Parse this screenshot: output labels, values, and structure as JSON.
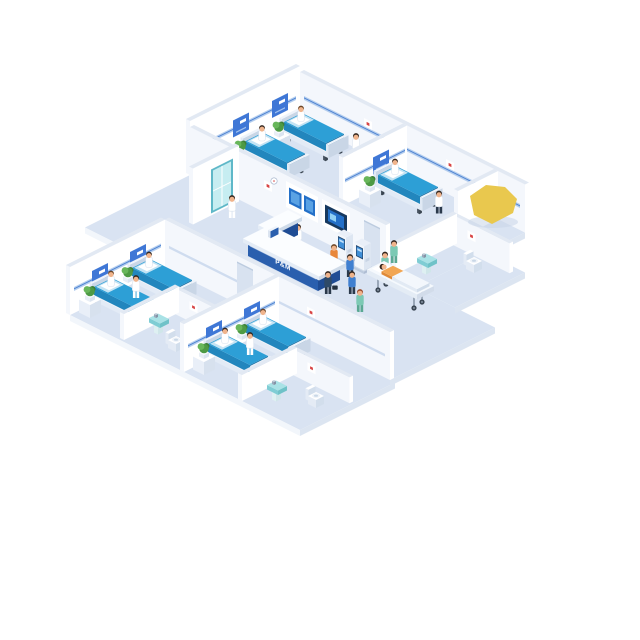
{
  "image": {
    "description": "Isometric cutaway illustration of a hospital ward floor with patient rooms, reception and corridor",
    "background": "#ffffff"
  },
  "reception": {
    "desk_label": "P&M"
  },
  "palette": {
    "floor": "#d9e3f2",
    "floor_edge_front": "#f2f6fb",
    "floor_edge_side": "#dce5f1",
    "wall_top": "#e2e9f3",
    "wall_face_left": "#f4f7fc",
    "wall_face_right": "#ffffff",
    "rail_light": "#b3cdee",
    "rail_dark": "#4a7fd0",
    "headboard_panel": "#3f77d6",
    "bed_mattress_top": "#2d9fd6",
    "bed_mattress_left": "#2286bd",
    "bed_mattress_right": "#1a6fa2",
    "bed_sheet": "#c3e3f4",
    "bed_frame_top": "#f2f6fb",
    "bed_frame_left": "#e3ebf6",
    "bed_frame_right": "#cdd9e8",
    "pillow": "#ffffff",
    "table_top": "#ffffff",
    "table_left": "#e9eff8",
    "table_right": "#d7e1ee",
    "pot": "#f6f9fc",
    "plant_dark": "#3d8038",
    "plant_mid": "#4e9a44",
    "plant_light": "#68b65a",
    "desk_front": "#2a5fae",
    "desk_front_side": "#1f4c94",
    "desk_stripe": "#9fb8dc",
    "desk_top": "#fbfdff",
    "desk_top_left": "#e4ecf6",
    "kiosk_frame": "#24466e",
    "kiosk_screen": "#3f8fd8",
    "viewer_screen": "#2470c8",
    "viewer_screen_light": "#5aa2e4",
    "viewer_screen_dark": "#17395f",
    "door": "#d8e2f0",
    "door_frame": "#bccbdf",
    "door_teal": "#c6edf1",
    "door_teal_frame": "#5fb8c8",
    "sink_top": "#a9e2e6",
    "sink_front": "#7fcdd4",
    "sink_side": "#6fc2c8",
    "fixture_white": "#ffffff",
    "fixture_shade": "#e4ebf5",
    "fixture_side": "#d2deec",
    "skin": "#f0b48c",
    "hair_dark": "#33261e",
    "hair_brown": "#6b4526",
    "hair_red": "#9a4a2a",
    "uniform_stroke": "#d9e2ee",
    "scrubs": "#7cc9b4",
    "scrubs_dark": "#5aa893",
    "suit": "#2e4a68",
    "shirt_blue": "#3f7fd0",
    "shirt_orange": "#e8873b",
    "pants_dark": "#2b3a4c",
    "wheel": "#3b4754",
    "gurney_top": "#f5f9fd",
    "highlight": "#e9c84e",
    "cross_red": "#d84545"
  },
  "scene": {
    "style": "isometric cutaway hospital floor",
    "rooms": [
      {
        "name": "ward-room-upper-left",
        "beds": 2,
        "patients": 2,
        "staff": [
          "nurse"
        ],
        "plants": 2
      },
      {
        "name": "ward-room-upper-right",
        "beds": 1,
        "patients": 1,
        "staff": [
          "doctor"
        ],
        "plants": 1
      },
      {
        "name": "ensuite-bathroom-right",
        "fixtures": [
          "sink",
          "toilet"
        ]
      },
      {
        "name": "entrance-alcove",
        "staff": [
          "staff-member"
        ],
        "features": [
          "teal-glass-door"
        ]
      },
      {
        "name": "reception-and-corridor",
        "staff": [
          "receptionist",
          "nurse-pushing-gurney",
          "nurse-walking",
          "nurse-scrubs"
        ],
        "visitors": 4,
        "equipment": [
          "reception-desk",
          "x-ray-viewer-panel",
          "x-ray-viewer-panel",
          "self-service-kiosk",
          "self-service-kiosk",
          "patient-gurney"
        ]
      },
      {
        "name": "ward-room-lower-left",
        "beds": 2,
        "patients": 2,
        "staff": [
          "nurse"
        ],
        "plants": 2
      },
      {
        "name": "ensuite-bathroom-lower-left",
        "fixtures": [
          "sink",
          "toilet"
        ]
      },
      {
        "name": "ward-room-lower-center",
        "beds": 2,
        "patients": 2,
        "staff": [
          "nurse"
        ],
        "plants": 2
      },
      {
        "name": "ensuite-bathroom-lower-center",
        "fixtures": [
          "sink",
          "toilet"
        ]
      }
    ],
    "totals": {
      "beds": 7,
      "patients_in_beds": 6,
      "patient_on_gurney": 1,
      "staff": 9,
      "visitors": 4,
      "plants": 7
    },
    "extras": [
      "yellow-highlight-shape-right-side"
    ]
  }
}
